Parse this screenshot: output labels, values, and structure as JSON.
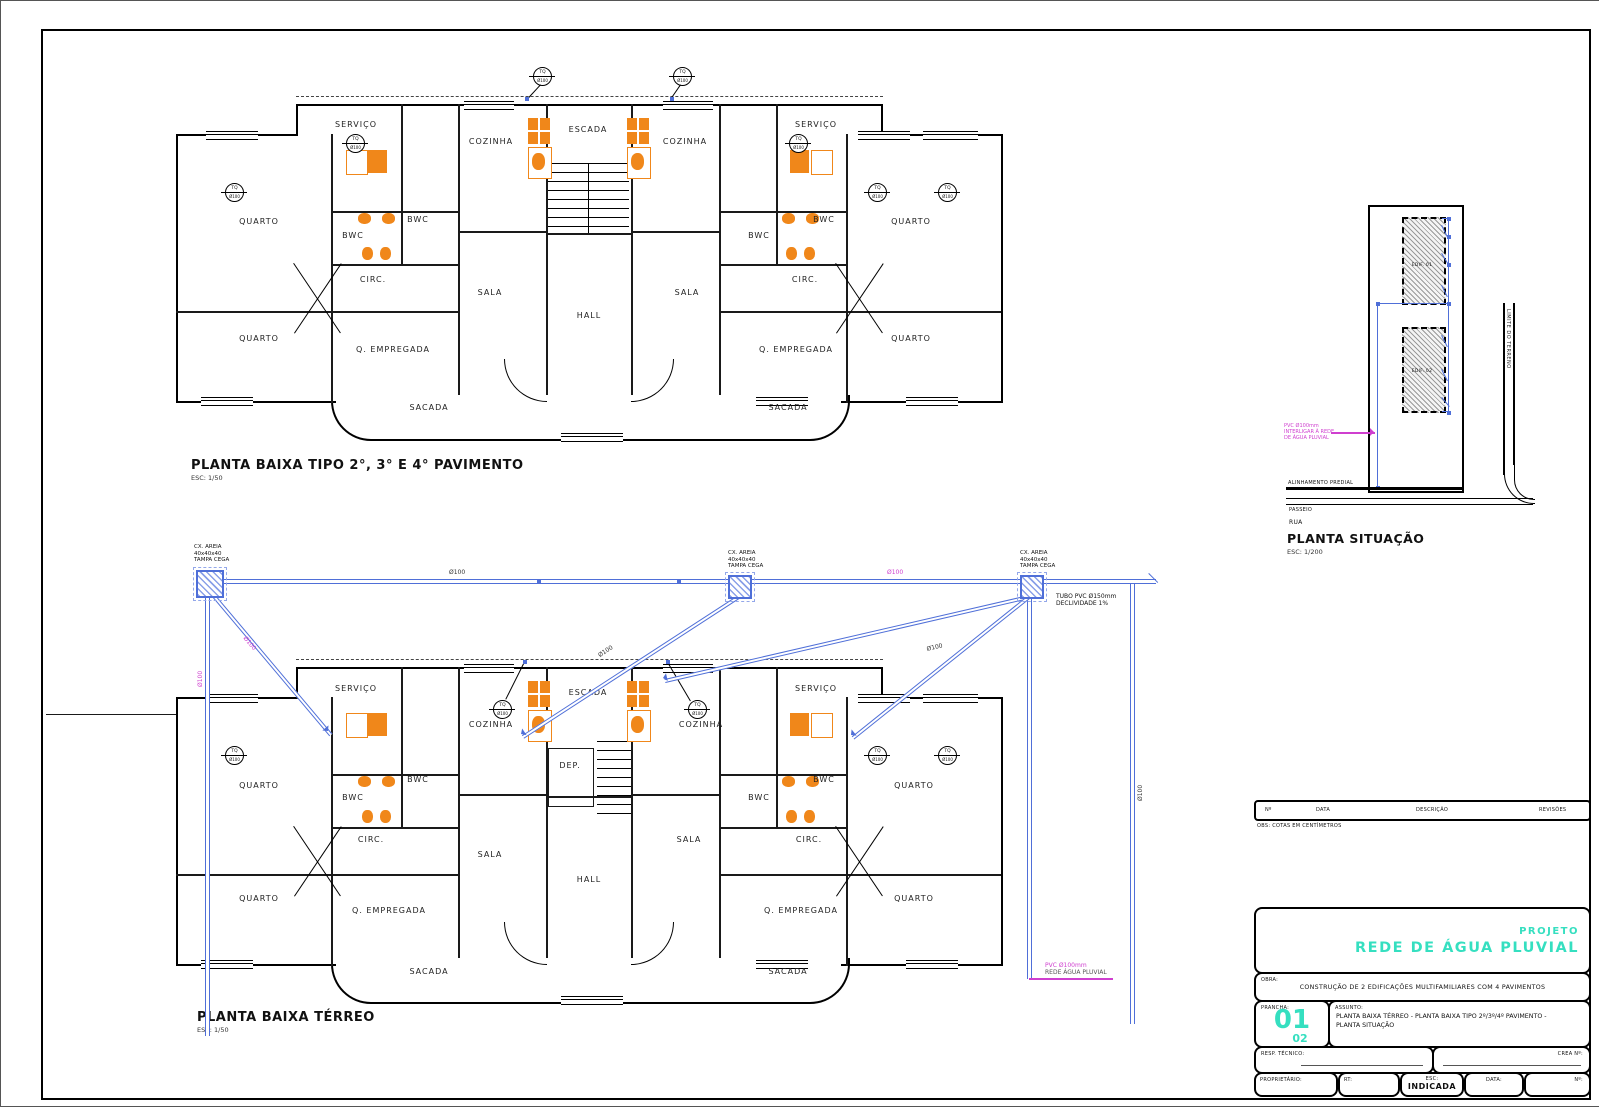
{
  "colors": {
    "pipe_blue": "#4f6fd8",
    "fixture_orange": "#f0871a",
    "accent_teal": "#35dfc0",
    "magenta": "#cf3fcf",
    "wall_black": "#000000"
  },
  "plans": {
    "rooms": {
      "servico": "SERVIÇO",
      "cozinha": "COZINHA",
      "escada": "ESCADA",
      "quarto": "QUARTO",
      "bwc": "BWC",
      "circ": "CIRC.",
      "sala": "SALA",
      "hall": "HALL",
      "empregada": "Q. EMPREGADA",
      "sacada": "SACADA",
      "dep": "DEP."
    },
    "upper": {
      "title": "PLANTA BAIXA TIPO 2°, 3° E 4° PAVIMENTO",
      "scale": "ESC: 1/50"
    },
    "ground": {
      "title": "PLANTA BAIXA TÉRREO",
      "scale": "ESC: 1/50"
    },
    "situation": {
      "title": "PLANTA SITUAÇÃO",
      "scale": "ESC: 1/200",
      "labels": {
        "edif1": "EDIF. 01",
        "edif2": "EDIF. 02",
        "alinhamento": "ALINHAMENTO PREDIAL",
        "passeio": "PASSEIO",
        "rua": "RUA",
        "limite": "LIMITE DO TERRENO"
      },
      "note": [
        "PVC Ø100mm",
        "INTERLIGAR À REDE",
        "DE ÁGUA PLUVIAL"
      ]
    }
  },
  "piping": {
    "caixa_lines": [
      "CX. AREIA",
      "40x40x40",
      "TAMPA CEGA"
    ],
    "pipe_label": "Ø100",
    "tq_top": "TQ",
    "tq_dn": "Ø100",
    "note_right": [
      "TUBO PVC Ø150mm",
      "DECLIVIDADE 1%"
    ],
    "note_bottom": [
      "PVC Ø100mm",
      "REDE ÁGUA PLUVIAL"
    ]
  },
  "titleblock": {
    "projeto": "PROJETO",
    "titulo": "REDE DE ÁGUA PLUVIAL",
    "obra_label": "OBRA:",
    "obra": "CONSTRUÇÃO DE 2 EDIFICAÇÕES MULTIFAMILIARES COM 4 PAVIMENTOS",
    "prancha_label": "PRANCHA:",
    "prancha": "01",
    "prancha_total": "02",
    "assunto_label": "ASSUNTO:",
    "assunto": [
      "PLANTA BAIXA TÉRREO - PLANTA BAIXA TIPO 2º/3º/4º PAVIMENTO -",
      "PLANTA SITUAÇÃO"
    ],
    "resp_label": "RESP. TÉCNICO:",
    "crea_label": "CREA Nº:",
    "prop_label": "PROPRIETÁRIO:",
    "rt_label": "RT:",
    "esc_label": "ESC:",
    "esc": "INDICADA",
    "data_label": "DATA:",
    "num_label": "Nº:",
    "rev_cols": [
      "Nº",
      "DATA",
      "DESCRIÇÃO",
      "REVISÕES"
    ],
    "note": "OBS: COTAS EM CENTÍMETROS"
  }
}
